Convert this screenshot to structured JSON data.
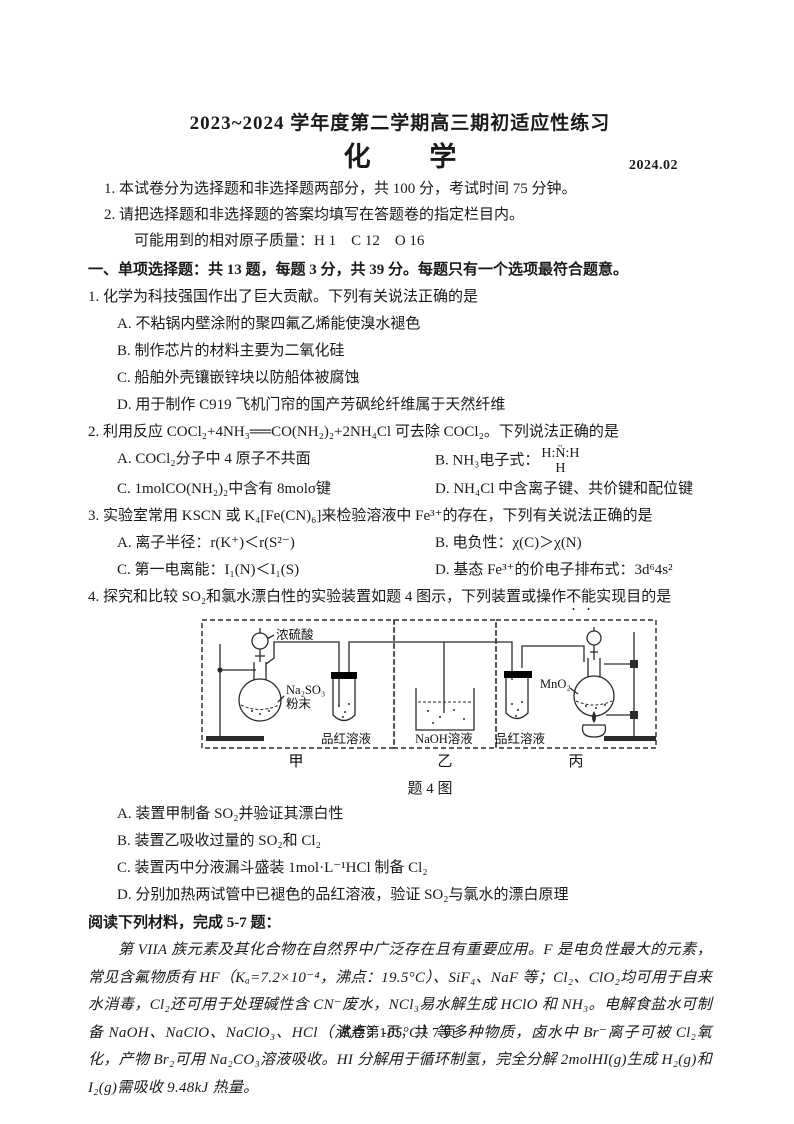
{
  "header": {
    "title": "2023~2024 学年度第二学期高三期初适应性练习",
    "subject": "化 学",
    "date": "2024.02",
    "note1": "1. 本试卷分为选择题和非选择题两部分，共 100 分，考试时间 75 分钟。",
    "note2": "2. 请把选择题和非选择题的答案均填写在答题卷的指定栏目内。",
    "atomic_mass": "可能用到的相对原子质量：H 1　C 12　O 16"
  },
  "section1": {
    "heading": "一、单项选择题：共 13 题，每题 3 分，共 39 分。每题只有一个选项最符合题意。"
  },
  "q1": {
    "stem": "1. 化学为科技强国作出了巨大贡献。下列有关说法正确的是",
    "options": [
      "A. 不粘锅内壁涂附的聚四氟乙烯能使溴水褪色",
      "B. 制作芯片的材料主要为二氧化硅",
      "C. 船舶外壳镶嵌锌块以防船体被腐蚀",
      "D. 用于制作 C919 飞机门帘的国产芳砜纶纤维属于天然纤维"
    ]
  },
  "q2": {
    "stem": "2. 利用反应 COCl₂+4NH₃══CO(NH₂)₂+2NH₄Cl 可去除 COCl₂。下列说法正确的是",
    "optA": "A. COCl₂分子中 4 原子不共面",
    "optB_label": "B. NH₃电子式：",
    "optB_formula_top": "H:N̈:H",
    "optB_formula_bottom": "H",
    "optC": "C. 1molCO(NH₂)₂中含有 8molσ键",
    "optD": "D. NH₄Cl 中含离子键、共价键和配位键"
  },
  "q3": {
    "stem": "3. 实验室常用 KSCN 或 K₄[Fe(CN)₆]来检验溶液中 Fe³⁺的存在，下列有关说法正确的是",
    "optA": "A. 离子半径：r(K⁺)＜r(S²⁻)",
    "optB": "B. 电负性：χ(C)＞χ(N)",
    "optC": "C. 第一电离能：I₁(N)＜I₁(S)",
    "optD": "D. 基态 Fe³⁺的价电子排布式：3d⁶4s²"
  },
  "q4": {
    "stem_prefix": "4. 探究和比较 SO₂和氯水漂白性的实验装置如题 4 图示，下列装置或操作",
    "stem_emphasis": "不能",
    "stem_suffix": "实现目的是",
    "options": [
      "A. 装置甲制备 SO₂并验证其漂白性",
      "B. 装置乙吸收过量的 SO₂和 Cl₂",
      "C. 装置丙中分液漏斗盛装 1mol·L⁻¹HCl 制备 Cl₂",
      "D. 分别加热两试管中已褪色的品红溶液，验证 SO₂与氯水的漂白原理"
    ],
    "figure": {
      "label_acid": "浓硫酸",
      "label_na2so3_line1": "Na₂SO₃",
      "label_na2so3_line2": "粉末",
      "label_fuchsin_left": "品红溶液",
      "label_naoh": "NaOH溶液",
      "label_fuchsin_right": "品红溶液",
      "label_mno2": "MnO₂",
      "label_jia": "甲",
      "label_yi": "乙",
      "label_bing": "丙",
      "caption": "题 4 图"
    }
  },
  "reading": {
    "heading": "阅读下列材料，完成 5-7 题：",
    "paragraph": "第 VIIA 族元素及其化合物在自然界中广泛存在且有重要应用。F 是电负性最大的元素，常见含氟物质有 HF（Kₐ=7.2×10⁻⁴，沸点：19.5°C）、SiF₄、NaF 等；Cl₂、ClO₂均可用于自来水消毒，Cl₂还可用于处理碱性含 CN⁻废水，NCl₃易水解生成 HClO 和 NH₃。电解食盐水可制备 NaOH、NaClO、NaClO₃、HCl（沸点：-85°C）等多种物质，卤水中 Br⁻离子可被 Cl₂氧化，产物 Br₂可用 Na₂CO₃溶液吸收。HI 分解用于循环制氢，完全分解 2molHI(g)生成 H₂(g)和 I₂(g)需吸收 9.48kJ 热量。"
  },
  "footer": {
    "page_info": "试卷第1页，共 7 页"
  }
}
